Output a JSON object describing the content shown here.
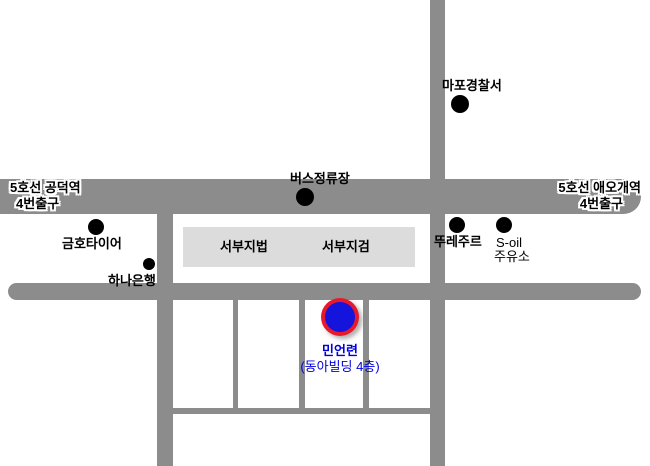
{
  "map": {
    "colors": {
      "background": "#ffffff",
      "road": "#8c8c8c",
      "building_box": "#dcdcdc",
      "marker_ring": "#e8192c",
      "marker_fill": "#1414dd",
      "destination_text": "#0000dd",
      "poi_dot": "#000000"
    },
    "stations": {
      "gongdeok": {
        "line1": "5호선 공덕역",
        "line2": "4번출구"
      },
      "aeogae": {
        "line1": "5호선 애오개역",
        "line2": "4번출구"
      }
    },
    "pois": {
      "mapo_police": {
        "label": "마포경찰서"
      },
      "bus_stop": {
        "label": "버스정류장"
      },
      "kumho_tire": {
        "label": "금호타이어"
      },
      "hana_bank": {
        "label": "하나은행"
      },
      "tous_les_jours": {
        "label": "뚜레주르"
      },
      "s_oil": {
        "label": "S-oil",
        "label2": "주유소"
      }
    },
    "buildings": {
      "court": "서부지법",
      "prosecutors": "서부지검"
    },
    "destination": {
      "name": "민언련",
      "building": "(동아빌딩 4층)"
    }
  }
}
